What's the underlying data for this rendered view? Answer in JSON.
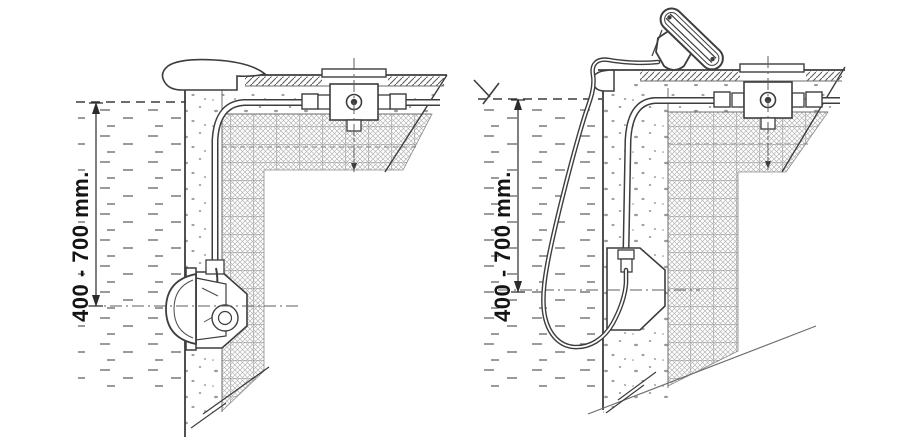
{
  "colors": {
    "background": "#ffffff",
    "line": "#3d3d3d",
    "hatch": "#9a9a9a",
    "text": "#141414"
  },
  "diagrams": {
    "installed": {
      "dimension_label": "400 - 700 mm."
    },
    "service": {
      "dimension_label": "400 - 700 mm."
    }
  },
  "icons": {
    "water_level_mark": "hand-drawn water-level tick",
    "dimension_arrows": "filled triangle arrowheads"
  }
}
